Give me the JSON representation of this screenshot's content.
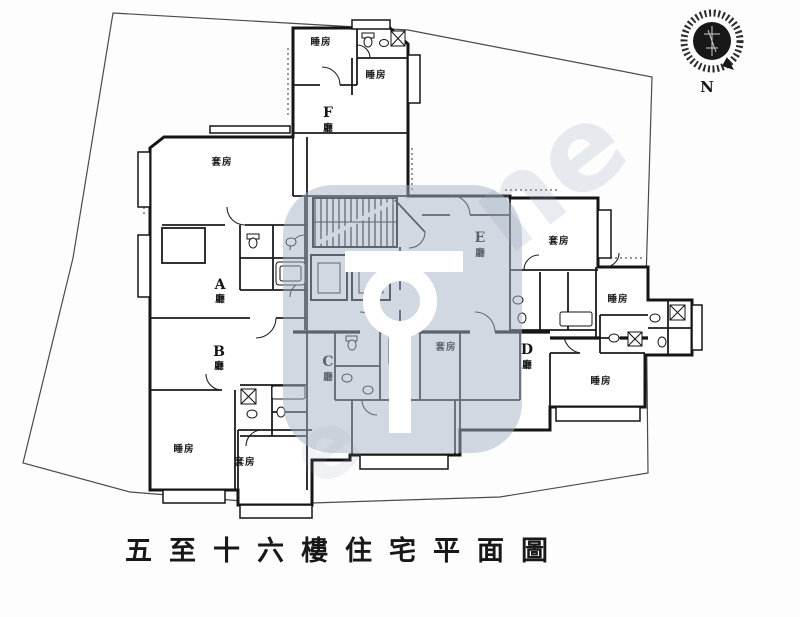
{
  "caption": {
    "text": "五至十六樓住宅平面圖"
  },
  "compass": {
    "label": "N"
  },
  "units": [
    {
      "letter": "A",
      "hall": "廳"
    },
    {
      "letter": "B",
      "hall": "廳"
    },
    {
      "letter": "C",
      "hall": "廳"
    },
    {
      "letter": "D",
      "hall": "廳"
    },
    {
      "letter": "E",
      "hall": "廳"
    },
    {
      "letter": "F",
      "hall": "廳"
    }
  ],
  "room_types": {
    "bedroom": "睡房",
    "master_suite": "套房"
  },
  "watermark": {
    "tint": "#a4b1c4",
    "logo_color": "#ffffff",
    "fragments": [
      "ne",
      "e"
    ]
  },
  "colors": {
    "line": "#1c1c1c",
    "boundary": "#4a4a4a",
    "background": "#ffffff"
  }
}
